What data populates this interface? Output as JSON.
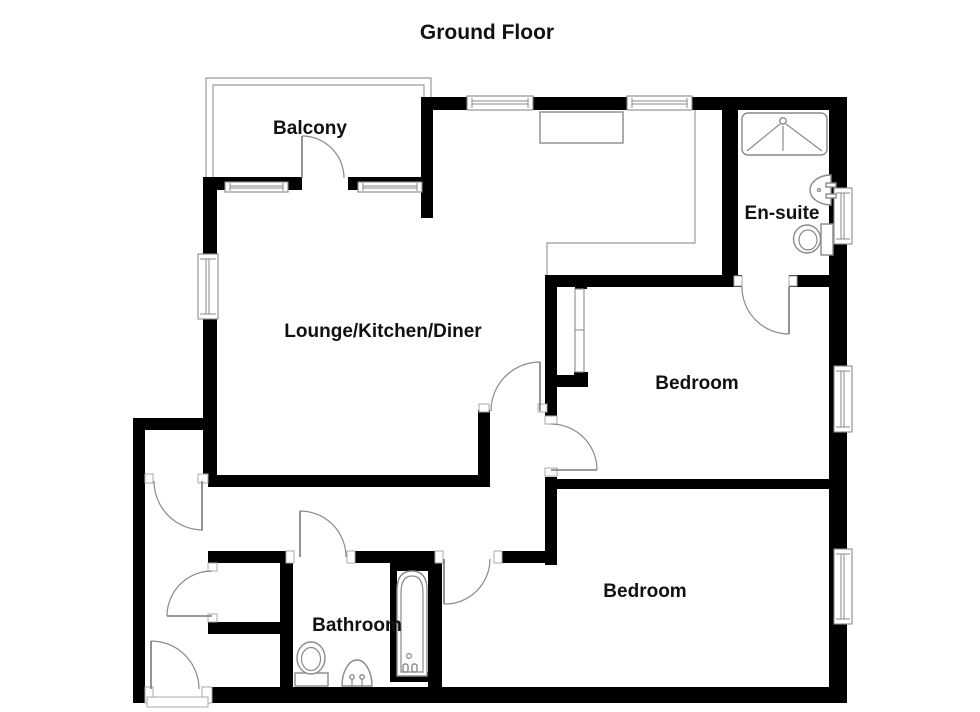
{
  "title": "Ground Floor",
  "rooms": {
    "balcony": "Balcony",
    "lounge": "Lounge/Kitchen/Diner",
    "ensuite": "En-suite",
    "bedroom1": "Bedroom",
    "bedroom2": "Bedroom",
    "bathroom": "Bathroom"
  },
  "colors": {
    "wall": "#000000",
    "line": "#8a8a8a",
    "background": "#ffffff",
    "text": "#111111"
  }
}
